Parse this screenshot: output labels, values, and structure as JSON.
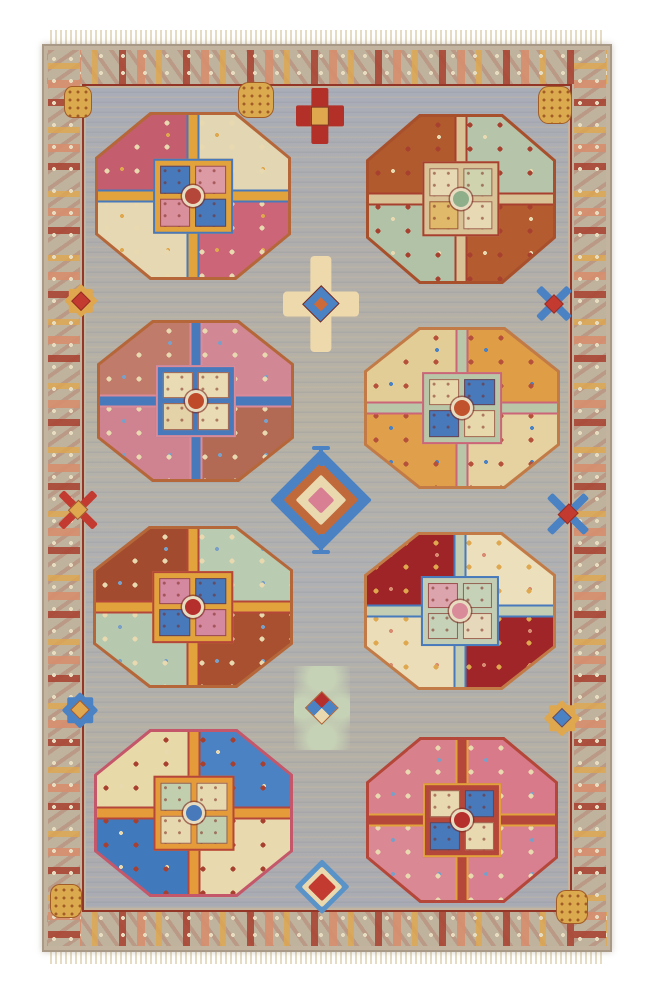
{
  "scene": {
    "subject": "hand-knotted oriental wool rug, grey field with eight octagonal gul medallions, photographed on white",
    "background": "#ffffff"
  },
  "rug": {
    "body": {
      "x": 42,
      "y": 44,
      "w": 570,
      "h": 908
    },
    "palette": {
      "fringe": "#e6dcc4",
      "border_ground": "#bfb39e",
      "border_red": "#a8402f",
      "border_salmon": "#d68e6e",
      "border_gold": "#dfa74e",
      "guard_red": "#933627",
      "field_grey": "#aeb0b4",
      "field_streak": "#c9ba9c"
    },
    "octagons": [
      {
        "x": 95,
        "y": 112,
        "w": 196,
        "h": 168,
        "outline": "#b5673a",
        "quadrants": [
          "#c45d6e",
          "#e3d6b2",
          "#e6d8b2",
          "#cb6577"
        ],
        "cross": "#e2a33c",
        "cross_edge": "#4779bb",
        "center_squares": [
          "#4779bb",
          "#dc9aa4",
          "#d9909c",
          "#4779bb"
        ],
        "dot": "#b5473a",
        "accents": [
          "#e8d9b0",
          "#dfa74e"
        ]
      },
      {
        "x": 366,
        "y": 114,
        "w": 190,
        "h": 170,
        "outline": "#a8502c",
        "quadrants": [
          "#b05a2e",
          "#b6c5a9",
          "#b2c2a6",
          "#b45c30"
        ],
        "cross": "#d9c296",
        "cross_edge": "#a8402f",
        "center_squares": [
          "#e7d9b3",
          "#cfd4ae",
          "#e0b96a",
          "#e7d9b3"
        ],
        "dot": "#8fae8a",
        "accents": [
          "#a8402f",
          "#e8d9b0"
        ]
      },
      {
        "x": 97,
        "y": 320,
        "w": 197,
        "h": 162,
        "outline": "#b5673a",
        "quadrants": [
          "#c07b6b",
          "#d28795",
          "#cf8390",
          "#b26a54"
        ],
        "cross": "#4779bb",
        "cross_edge": "#d98b9a",
        "center_squares": [
          "#e9dcb4",
          "#e9dcb4",
          "#e4d2a8",
          "#e9dcb4"
        ],
        "dot": "#bf4a2a",
        "accents": [
          "#e8d9b0",
          "#7aa0c8"
        ]
      },
      {
        "x": 364,
        "y": 327,
        "w": 196,
        "h": 162,
        "outline": "#c27b46",
        "quadrants": [
          "#e2cd96",
          "#df9d45",
          "#e0a04b",
          "#e5d2a0"
        ],
        "cross": "#b9c7a8",
        "cross_edge": "#cb6577",
        "center_squares": [
          "#e8d9ad",
          "#4779bb",
          "#4779bb",
          "#e8d9ad"
        ],
        "dot": "#c0532e",
        "accents": [
          "#b5503a",
          "#4a82c4"
        ]
      },
      {
        "x": 93,
        "y": 526,
        "w": 200,
        "h": 162,
        "outline": "#b5673a",
        "quadrants": [
          "#a34b2e",
          "#b9cbb0",
          "#b6c8ad",
          "#a8502f"
        ],
        "cross": "#e2a33c",
        "cross_edge": "#b5473a",
        "center_squares": [
          "#d489a0",
          "#4779bb",
          "#4779bb",
          "#d489a0"
        ],
        "dot": "#b5302c",
        "accents": [
          "#e8d9b0",
          "#7aa0c8"
        ]
      },
      {
        "x": 364,
        "y": 532,
        "w": 192,
        "h": 158,
        "outline": "#c27b46",
        "quadrants": [
          "#9e2428",
          "#ecdfbb",
          "#eaddb8",
          "#a02529"
        ],
        "cross": "#c3cdb4",
        "cross_edge": "#4779bb",
        "center_squares": [
          "#dca4ad",
          "#c6d2b8",
          "#c6d2b8",
          "#e6d8ba"
        ],
        "dot": "#d98b9a",
        "accents": [
          "#dfa74e",
          "#d98b72"
        ]
      },
      {
        "x": 94,
        "y": 729,
        "w": 199,
        "h": 168,
        "outline": "#c4586a",
        "quadrants": [
          "#e8d9a8",
          "#4a82c4",
          "#4179bd",
          "#e9d9ae"
        ],
        "cross": "#e59b3a",
        "cross_edge": "#b5473a",
        "center_squares": [
          "#c2cfae",
          "#e6d9b0",
          "#e6d9b0",
          "#c2cfae"
        ],
        "dot": "#4779bb",
        "accents": [
          "#a8402f",
          "#e8d9b0"
        ]
      },
      {
        "x": 366,
        "y": 737,
        "w": 192,
        "h": 166,
        "outline": "#b5473a",
        "quadrants": [
          "#d8818c",
          "#d87a8a",
          "#da8893",
          "#d87f90"
        ],
        "cross": "#b5473a",
        "cross_edge": "#e2a33c",
        "center_squares": [
          "#e8d9b0",
          "#4779bb",
          "#4779bb",
          "#e8d9b0"
        ],
        "dot": "#b5302c",
        "accents": [
          "#e8d9b0",
          "#7aa0c8"
        ]
      }
    ],
    "motifs": [
      {
        "type": "cross",
        "x": 296,
        "y": 88,
        "w": 48,
        "h": 56,
        "main": "#b23028",
        "accent": "#dfa74e"
      },
      {
        "type": "hook-cross",
        "x": 283,
        "y": 256,
        "w": 76,
        "h": 96,
        "main": "#eed9ac",
        "accent": "#4a82c4",
        "core": "#cc6a3a"
      },
      {
        "type": "step-diamond",
        "x": 285,
        "y": 446,
        "w": 72,
        "h": 108,
        "c1": "#4a82c4",
        "c2": "#c06a3c",
        "c3": "#ead9ae",
        "c4": "#d87f94",
        "hooks": true
      },
      {
        "type": "floral-checker",
        "x": 294,
        "y": 666,
        "w": 56,
        "h": 84,
        "main": "#c6d2b5",
        "accent1": "#4a82c4",
        "accent2": "#b5302c"
      },
      {
        "type": "step-diamond",
        "x": 298,
        "y": 858,
        "w": 48,
        "h": 58,
        "c1": "#5a93c8",
        "c2": "#ead9ae",
        "c3": "#c23a30",
        "c4": "#c23a30",
        "hooks": false
      },
      {
        "type": "star8",
        "x": 60,
        "y": 280,
        "w": 42,
        "h": 42,
        "main": "#dfa74e",
        "center": "#c23a30"
      },
      {
        "type": "x-cross",
        "x": 534,
        "y": 284,
        "w": 40,
        "h": 40,
        "main": "#4a82c4",
        "center": "#c23a30"
      },
      {
        "type": "x-cross",
        "x": 58,
        "y": 488,
        "w": 40,
        "h": 44,
        "main": "#c23a30",
        "center": "#dfa74e"
      },
      {
        "type": "x-cross",
        "x": 548,
        "y": 490,
        "w": 40,
        "h": 48,
        "main": "#4a82c4",
        "center": "#c23a30"
      },
      {
        "type": "star8",
        "x": 58,
        "y": 688,
        "w": 44,
        "h": 44,
        "main": "#4a82c4",
        "center": "#dfa74e"
      },
      {
        "type": "star8",
        "x": 540,
        "y": 696,
        "w": 44,
        "h": 44,
        "main": "#dfa74e",
        "center": "#4a82c4"
      },
      {
        "type": "dotted-ball",
        "x": 64,
        "y": 86,
        "w": 26,
        "h": 30
      },
      {
        "type": "dotted-ball",
        "x": 238,
        "y": 82,
        "w": 34,
        "h": 34
      },
      {
        "type": "dotted-ball",
        "x": 538,
        "y": 86,
        "w": 32,
        "h": 36
      },
      {
        "type": "dotted-ball",
        "x": 50,
        "y": 884,
        "w": 30,
        "h": 32
      },
      {
        "type": "dotted-ball",
        "x": 556,
        "y": 890,
        "w": 30,
        "h": 32
      }
    ],
    "ball_color": "#dba94e",
    "ball_dot": "#a25c28"
  }
}
